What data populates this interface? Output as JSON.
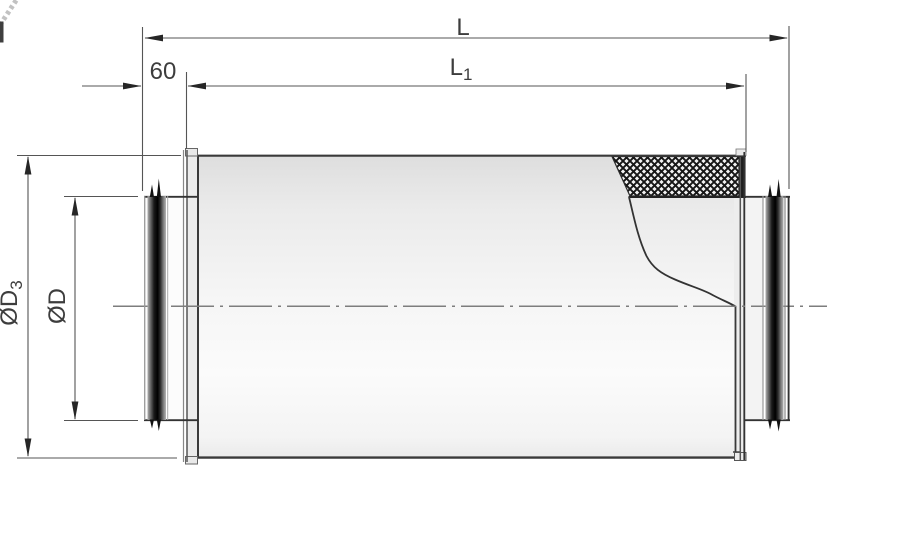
{
  "canvas": {
    "width": 900,
    "height": 536
  },
  "labels": {
    "overall_length": {
      "text": "L",
      "sub": ""
    },
    "casing_length": {
      "text": "L",
      "sub": "1"
    },
    "spigot_length": {
      "text": "60",
      "sub": ""
    },
    "outer_diameter": {
      "text": "ØD",
      "sub": "3"
    },
    "duct_diameter": {
      "text": "ØD",
      "sub": ""
    }
  },
  "colors": {
    "background": "#ffffff",
    "ink": "#3d3d3d",
    "outline": "#3a3a3a",
    "dim-line": "#555555",
    "arrow": "#262626",
    "centerline": "#7d7d7d",
    "body-light": "#fbfbfb",
    "body-shade": "#dedede",
    "rib-dark": "#0a0a0a",
    "hatch-line": "#161616",
    "hatch-bg": "#f2f2f2"
  }
}
